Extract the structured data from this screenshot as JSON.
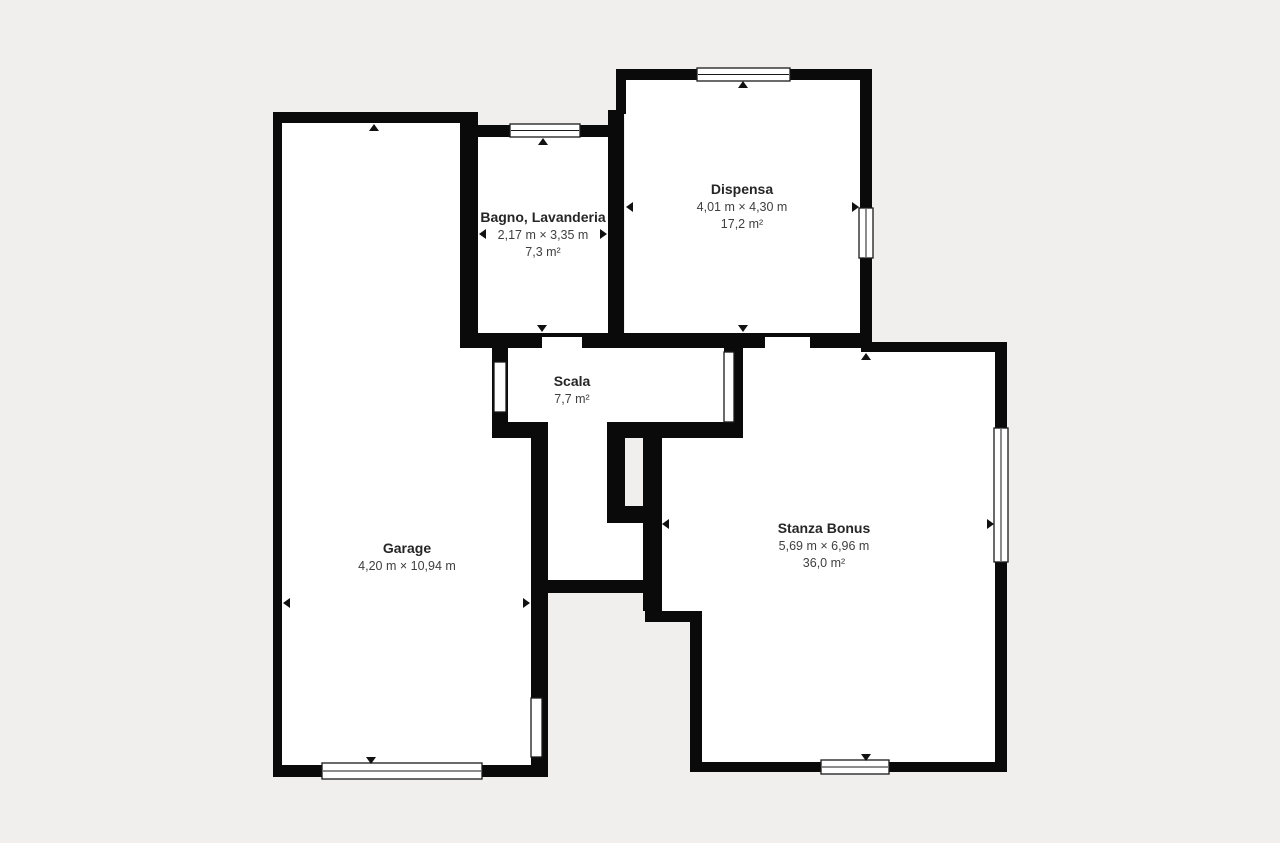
{
  "canvas": {
    "width": 1280,
    "height": 843
  },
  "colors": {
    "background": "#f0efed",
    "wall": "#0a0a0a",
    "room_fill": "#ffffff",
    "window_fill": "#ffffff",
    "window_border": "#1a1a1a",
    "room_name_text": "#262626",
    "room_dims_text": "#3f3f3f",
    "arrow": "#111111"
  },
  "rooms": [
    {
      "id": "bagno",
      "name": "Bagno, Lavanderia",
      "dimensions": "2,17 m × 3,35 m",
      "area": "7,3 m²",
      "label_x": 543,
      "label_y": 222
    },
    {
      "id": "dispensa",
      "name": "Dispensa",
      "dimensions": "4,01 m × 4,30 m",
      "area": "17,2 m²",
      "label_x": 742,
      "label_y": 194
    },
    {
      "id": "scala",
      "name": "Scala",
      "dimensions": "",
      "area": "7,7 m²",
      "label_x": 572,
      "label_y": 386
    },
    {
      "id": "garage",
      "name": "Garage",
      "dimensions": "4,20 m × 10,94 m",
      "area": "",
      "label_x": 407,
      "label_y": 553
    },
    {
      "id": "stanza-bonus",
      "name": "Stanza Bonus",
      "dimensions": "5,69 m × 6,96 m",
      "area": "36,0 m²",
      "label_x": 824,
      "label_y": 533
    }
  ],
  "floor_polygons": [
    {
      "id": "garage-floor",
      "points": [
        [
          282,
          123
        ],
        [
          460,
          123
        ],
        [
          460,
          348
        ],
        [
          492,
          348
        ],
        [
          492,
          438
        ],
        [
          533,
          438
        ],
        [
          533,
          765
        ],
        [
          282,
          765
        ]
      ]
    },
    {
      "id": "bagno-floor",
      "points": [
        [
          478,
          137
        ],
        [
          608,
          137
        ],
        [
          608,
          333
        ],
        [
          478,
          333
        ]
      ]
    },
    {
      "id": "dispensa-floor",
      "points": [
        [
          625,
          80
        ],
        [
          860,
          80
        ],
        [
          860,
          333
        ],
        [
          625,
          333
        ]
      ]
    },
    {
      "id": "scala-floor",
      "points": [
        [
          508,
          348
        ],
        [
          724,
          348
        ],
        [
          724,
          422
        ],
        [
          607,
          422
        ],
        [
          607,
          523
        ],
        [
          645,
          523
        ],
        [
          645,
          580
        ],
        [
          548,
          580
        ],
        [
          548,
          422
        ],
        [
          508,
          422
        ]
      ]
    },
    {
      "id": "stanza-bonus-floor",
      "points": [
        [
          743,
          348
        ],
        [
          870,
          348
        ],
        [
          870,
          352
        ],
        [
          997,
          352
        ],
        [
          997,
          762
        ],
        [
          702,
          762
        ],
        [
          702,
          611
        ],
        [
          660,
          611
        ],
        [
          660,
          438
        ],
        [
          743,
          438
        ]
      ]
    }
  ],
  "walls": [
    {
      "id": "garage-top-wall",
      "x": 273,
      "y": 112,
      "w": 197,
      "h": 11
    },
    {
      "id": "garage-left-wall",
      "x": 273,
      "y": 112,
      "w": 9,
      "h": 665
    },
    {
      "id": "garage-bottom-wall",
      "x": 273,
      "y": 765,
      "w": 275,
      "h": 12
    },
    {
      "id": "bagno-left-wall",
      "x": 460,
      "y": 112,
      "w": 18,
      "h": 236
    },
    {
      "id": "bagno-top-wall",
      "x": 460,
      "y": 125,
      "w": 164,
      "h": 12
    },
    {
      "id": "bagno-dispensa-wall",
      "x": 608,
      "y": 110,
      "w": 16,
      "h": 238
    },
    {
      "id": "dispensa-left-wall",
      "x": 616,
      "y": 69,
      "w": 10,
      "h": 45
    },
    {
      "id": "dispensa-top-wall",
      "x": 616,
      "y": 69,
      "w": 254,
      "h": 11
    },
    {
      "id": "dispensa-right-wall",
      "x": 860,
      "y": 69,
      "w": 12,
      "h": 279
    },
    {
      "id": "south-wall",
      "x": 460,
      "y": 333,
      "w": 410,
      "h": 15
    },
    {
      "id": "stanza-top-wall",
      "x": 861,
      "y": 342,
      "w": 146,
      "h": 10
    },
    {
      "id": "stanza-right-wall",
      "x": 995,
      "y": 342,
      "w": 12,
      "h": 430
    },
    {
      "id": "stanza-bottom-wall",
      "x": 690,
      "y": 762,
      "w": 317,
      "h": 10
    },
    {
      "id": "stanza-left-lower-wall",
      "x": 690,
      "y": 611,
      "w": 12,
      "h": 161
    },
    {
      "id": "step-wall",
      "x": 645,
      "y": 611,
      "w": 57,
      "h": 11
    },
    {
      "id": "stairwell-right-wall",
      "x": 643,
      "y": 422,
      "w": 19,
      "h": 189
    },
    {
      "id": "scala-bottom-wall-right",
      "x": 607,
      "y": 422,
      "w": 136,
      "h": 16
    },
    {
      "id": "scala-right-wall",
      "x": 724,
      "y": 348,
      "w": 19,
      "h": 90
    },
    {
      "id": "stairwell-left-wall",
      "x": 607,
      "y": 422,
      "w": 18,
      "h": 101
    },
    {
      "id": "stairwell-bottom-wall",
      "x": 607,
      "y": 506,
      "w": 55,
      "h": 17
    },
    {
      "id": "scala-bottom-wall-left",
      "x": 492,
      "y": 422,
      "w": 56,
      "h": 16
    },
    {
      "id": "scala-left-wall",
      "x": 492,
      "y": 348,
      "w": 16,
      "h": 74
    },
    {
      "id": "garage-right-wall",
      "x": 531,
      "y": 422,
      "w": 17,
      "h": 355
    },
    {
      "id": "corridor-bottom-wall",
      "x": 531,
      "y": 580,
      "w": 130,
      "h": 13
    }
  ],
  "door_gaps": [
    {
      "id": "bagno-door-gap",
      "x": 542,
      "y": 337,
      "w": 40,
      "h": 11
    },
    {
      "id": "dispensa-door-gap",
      "x": 765,
      "y": 337,
      "w": 45,
      "h": 11
    }
  ],
  "windows": [
    {
      "id": "bagno-top-window",
      "x": 510,
      "y": 124,
      "w": 70,
      "h": 13,
      "line": "h"
    },
    {
      "id": "dispensa-top-window",
      "x": 697,
      "y": 68,
      "w": 93,
      "h": 13,
      "line": "h"
    },
    {
      "id": "dispensa-right-window",
      "x": 859,
      "y": 208,
      "w": 14,
      "h": 50,
      "line": "v"
    },
    {
      "id": "scala-left-window",
      "x": 494,
      "y": 362,
      "w": 12,
      "h": 50,
      "line": ""
    },
    {
      "id": "scala-door",
      "x": 724,
      "y": 352,
      "w": 10,
      "h": 70,
      "line": ""
    },
    {
      "id": "stanza-right-window",
      "x": 994,
      "y": 428,
      "w": 14,
      "h": 134,
      "line": "v"
    },
    {
      "id": "stanza-bottom-window",
      "x": 821,
      "y": 760,
      "w": 68,
      "h": 14,
      "line": "h"
    },
    {
      "id": "garage-bottom-window",
      "x": 322,
      "y": 763,
      "w": 160,
      "h": 16,
      "line": "h"
    },
    {
      "id": "garage-right-window",
      "x": 531,
      "y": 698,
      "w": 11,
      "h": 59,
      "line": ""
    }
  ],
  "arrows": [
    {
      "id": "garage-arrow-up",
      "x": 374,
      "y": 124,
      "dir": "up"
    },
    {
      "id": "garage-arrow-down",
      "x": 371,
      "y": 764,
      "dir": "down"
    },
    {
      "id": "garage-arrow-left",
      "x": 283,
      "y": 603,
      "dir": "left"
    },
    {
      "id": "garage-arrow-right",
      "x": 530,
      "y": 603,
      "dir": "right"
    },
    {
      "id": "bagno-arrow-up",
      "x": 543,
      "y": 138,
      "dir": "up"
    },
    {
      "id": "bagno-arrow-down",
      "x": 542,
      "y": 332,
      "dir": "down"
    },
    {
      "id": "bagno-arrow-left",
      "x": 479,
      "y": 234,
      "dir": "left"
    },
    {
      "id": "bagno-arrow-right",
      "x": 607,
      "y": 234,
      "dir": "right"
    },
    {
      "id": "dispensa-arrow-up",
      "x": 743,
      "y": 81,
      "dir": "up"
    },
    {
      "id": "dispensa-arrow-down",
      "x": 743,
      "y": 332,
      "dir": "down"
    },
    {
      "id": "dispensa-arrow-left",
      "x": 626,
      "y": 207,
      "dir": "left"
    },
    {
      "id": "dispensa-arrow-right",
      "x": 859,
      "y": 207,
      "dir": "right"
    },
    {
      "id": "stanza-arrow-up",
      "x": 866,
      "y": 353,
      "dir": "up"
    },
    {
      "id": "stanza-arrow-down",
      "x": 866,
      "y": 761,
      "dir": "down"
    },
    {
      "id": "stanza-arrow-left",
      "x": 662,
      "y": 524,
      "dir": "left"
    },
    {
      "id": "stanza-arrow-right",
      "x": 994,
      "y": 524,
      "dir": "right"
    }
  ],
  "label_style": {
    "name_size": 14,
    "dims_size": 12.5,
    "line_gap": 17
  }
}
